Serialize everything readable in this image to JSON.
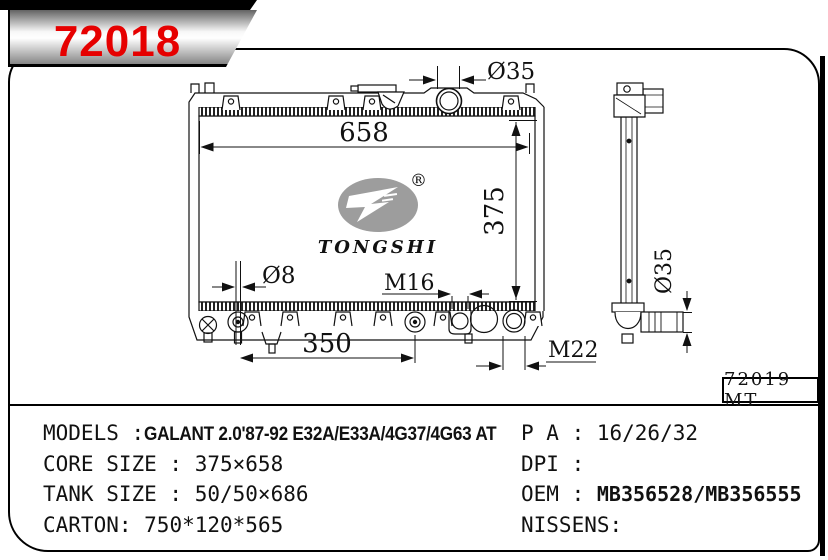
{
  "banner": {
    "part_number": "72018",
    "accent_color": "#e60000"
  },
  "drawing": {
    "ref_label": "72019 MT",
    "logo": {
      "brand": "TONGSHI",
      "registered": "®"
    },
    "dims": {
      "core_width": "658",
      "core_height": "375",
      "mount_span": "350",
      "filler_neck_dia": "Ø35",
      "pin_dia": "Ø8",
      "inlet_thread": "M16",
      "drain_thread": "M22",
      "outlet_dia": "Ø35"
    }
  },
  "specs": {
    "left": [
      {
        "label": "MODELS :",
        "value": "GALANT 2.0'87-92 E32A/E33A/4G37/4G63 AT"
      },
      {
        "label": "CORE SIZE : ",
        "value": "375×658"
      },
      {
        "label": "TANK SIZE : ",
        "value": "50/50×686"
      },
      {
        "label": "CARTON: ",
        "value": "750*120*565"
      }
    ],
    "right": [
      {
        "label": "P A : ",
        "value": "16/26/32"
      },
      {
        "label": "DPI : ",
        "value": ""
      },
      {
        "label": "OEM : ",
        "value": "MB356528/MB356555"
      },
      {
        "label": "NISSENS:",
        "value": ""
      }
    ]
  }
}
